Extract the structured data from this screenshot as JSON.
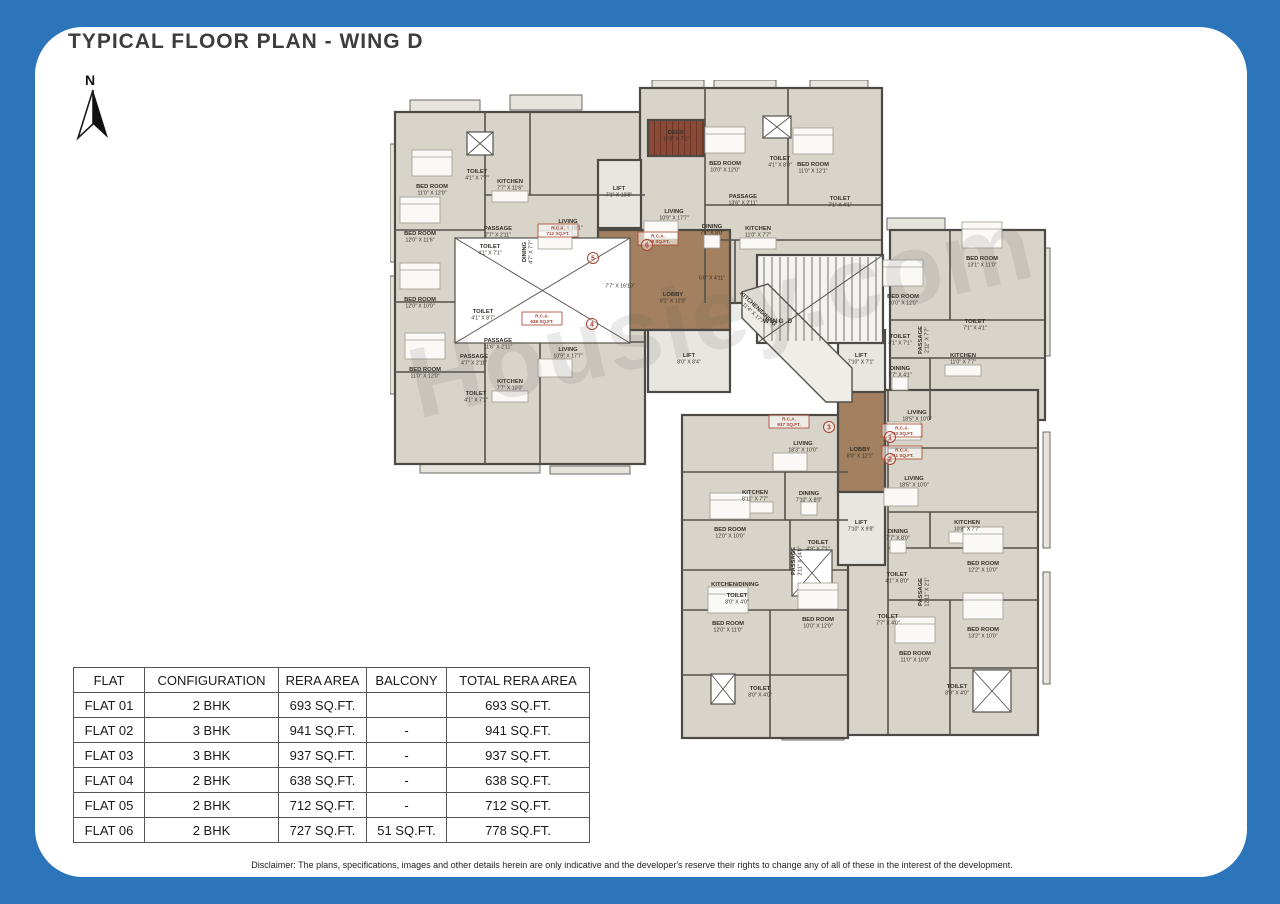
{
  "page": {
    "title": "TYPICAL FLOOR PLAN - WING D",
    "north_label": "N",
    "watermark": "Housiey.com",
    "disclaimer": "Disclaimer: The plans, specifications, images and other details herein are only indicative and the developer's reserve their rights to change any of all of these in the interest of the development.",
    "background_color": "#2c75ba"
  },
  "table": {
    "headers": [
      "FLAT",
      "CONFIGURATION",
      "RERA AREA",
      "BALCONY",
      "TOTAL RERA AREA"
    ],
    "rows": [
      [
        "FLAT 01",
        "2 BHK",
        "693 SQ.FT.",
        "",
        "693 SQ.FT."
      ],
      [
        "FLAT 02",
        "3 BHK",
        "941 SQ.FT.",
        "-",
        "941 SQ.FT."
      ],
      [
        "FLAT 03",
        "3 BHK",
        "937 SQ.FT.",
        "-",
        "937 SQ.FT."
      ],
      [
        "FLAT 04",
        "2 BHK",
        "638 SQ.FT.",
        "-",
        "638 SQ.FT."
      ],
      [
        "FLAT 05",
        "2 BHK",
        "712 SQ.FT.",
        "-",
        "712 SQ.FT."
      ],
      [
        "FLAT 06",
        "2 BHK",
        "727 SQ.FT.",
        "51 SQ.FT.",
        "778 SQ.FT."
      ]
    ]
  },
  "plan": {
    "colors": {
      "unit": "#d9d4c9",
      "lobby": "#a3805f",
      "lift": "#e8e6e0",
      "stair": "#f4f3ef",
      "corridor": "#efede7",
      "balcony": "#e7e4dd",
      "wall": "#4d4a45",
      "innerwall": "#55524c",
      "deck": "#8a4a38",
      "deckline": "#6e3527",
      "label": "#34302a",
      "red": "#a8422f",
      "furn": "#faf9f6",
      "furnline": "#a09a90"
    },
    "blocks": [
      {
        "x": 5,
        "y": 32,
        "w": 250,
        "h": 352,
        "f": "unit"
      },
      {
        "x": 250,
        "y": 8,
        "w": 242,
        "h": 215,
        "f": "unit"
      },
      {
        "x": 500,
        "y": 150,
        "w": 155,
        "h": 190,
        "f": "unit"
      },
      {
        "x": 455,
        "y": 310,
        "w": 193,
        "h": 345,
        "f": "unit"
      },
      {
        "x": 292,
        "y": 335,
        "w": 166,
        "h": 323,
        "f": "unit"
      },
      {
        "x": 208,
        "y": 150,
        "w": 132,
        "h": 100,
        "f": "lobby"
      },
      {
        "x": 448,
        "y": 300,
        "w": 47,
        "h": 112,
        "f": "lobby"
      },
      {
        "x": 208,
        "y": 80,
        "w": 43,
        "h": 68,
        "f": "lift"
      },
      {
        "x": 258,
        "y": 250,
        "w": 82,
        "h": 62,
        "f": "lift"
      },
      {
        "x": 448,
        "y": 250,
        "w": 47,
        "h": 62,
        "f": "lift"
      },
      {
        "x": 448,
        "y": 412,
        "w": 47,
        "h": 73,
        "f": "lift"
      },
      {
        "x": 367,
        "y": 175,
        "w": 126,
        "h": 88,
        "f": "stair"
      },
      {
        "x": 258,
        "y": 40,
        "w": 56,
        "h": 36,
        "f": "deck"
      }
    ],
    "corridor": {
      "points": "352,212 378,204 462,288 462,322 436,322 352,238"
    },
    "balconies": [
      [
        20,
        20,
        70,
        13
      ],
      [
        120,
        15,
        72,
        15
      ],
      [
        0,
        64,
        7,
        118
      ],
      [
        0,
        196,
        7,
        118
      ],
      [
        262,
        0,
        52,
        9
      ],
      [
        324,
        0,
        62,
        9
      ],
      [
        420,
        0,
        58,
        9
      ],
      [
        497,
        138,
        58,
        12
      ],
      [
        653,
        168,
        7,
        108
      ],
      [
        653,
        352,
        7,
        116
      ],
      [
        653,
        492,
        7,
        112
      ],
      [
        308,
        650,
        72,
        8
      ],
      [
        392,
        652,
        62,
        8
      ],
      [
        462,
        646,
        66,
        9
      ],
      [
        548,
        642,
        66,
        10
      ],
      [
        30,
        384,
        120,
        9
      ],
      [
        160,
        386,
        80,
        8
      ]
    ],
    "xboxes": [
      [
        65,
        158,
        175,
        105
      ],
      [
        77,
        52,
        26,
        23
      ],
      [
        373,
        36,
        28,
        22
      ],
      [
        402,
        470,
        40,
        46
      ],
      [
        321,
        594,
        24,
        30
      ],
      [
        583,
        590,
        38,
        42
      ]
    ],
    "walls": [
      [
        5,
        150,
        95,
        150
      ],
      [
        5,
        222,
        95,
        222
      ],
      [
        5,
        292,
        95,
        292
      ],
      [
        95,
        32,
        95,
        384
      ],
      [
        95,
        115,
        255,
        115
      ],
      [
        95,
        262,
        255,
        262
      ],
      [
        140,
        32,
        140,
        115
      ],
      [
        150,
        262,
        150,
        384
      ],
      [
        315,
        8,
        315,
        223
      ],
      [
        398,
        8,
        398,
        125
      ],
      [
        315,
        125,
        492,
        125
      ],
      [
        315,
        160,
        492,
        160
      ],
      [
        345,
        160,
        345,
        223
      ],
      [
        560,
        150,
        560,
        240
      ],
      [
        500,
        240,
        655,
        240
      ],
      [
        500,
        278,
        655,
        278
      ],
      [
        540,
        278,
        540,
        340
      ],
      [
        498,
        310,
        498,
        655
      ],
      [
        498,
        368,
        648,
        368
      ],
      [
        498,
        432,
        648,
        432
      ],
      [
        498,
        468,
        648,
        468
      ],
      [
        498,
        520,
        648,
        520
      ],
      [
        540,
        432,
        540,
        468
      ],
      [
        560,
        520,
        560,
        655
      ],
      [
        560,
        588,
        648,
        588
      ],
      [
        292,
        392,
        458,
        392
      ],
      [
        292,
        440,
        458,
        440
      ],
      [
        395,
        392,
        395,
        440
      ],
      [
        292,
        490,
        458,
        490
      ],
      [
        400,
        440,
        400,
        490
      ],
      [
        292,
        530,
        458,
        530
      ],
      [
        380,
        530,
        380,
        658
      ],
      [
        292,
        595,
        458,
        595
      ]
    ],
    "stairs": {
      "x": 367,
      "y": 175,
      "w": 126,
      "h": 88
    },
    "labels": [
      {
        "t": "BED ROOM",
        "d": "11'0\" X 12'0\"",
        "x": 42,
        "y": 108
      },
      {
        "t": "TOILET",
        "d": "4'1\" X 7'7\"",
        "x": 87,
        "y": 93
      },
      {
        "t": "KITCHEN",
        "d": "7'7\" X 11'6\"",
        "x": 120,
        "y": 103
      },
      {
        "t": "PASSAGE",
        "d": "7'7\" X 2'11\"",
        "x": 108,
        "y": 150
      },
      {
        "t": "LIVING",
        "d": "12'0\" X 18'1\"",
        "x": 178,
        "y": 143
      },
      {
        "t": "BED ROOM",
        "d": "12'0\" X 11'6\"",
        "x": 30,
        "y": 155
      },
      {
        "t": "TOILET",
        "d": "4'1\" X 7'1\"",
        "x": 100,
        "y": 168
      },
      {
        "t": "DINING",
        "d": "4'7\" X 7'7\"",
        "x": 136,
        "y": 172,
        "rot": -90
      },
      {
        "t": "TOILET",
        "d": "4'1\" X 8'7\"",
        "x": 93,
        "y": 233
      },
      {
        "t": "BED ROOM",
        "d": "12'0\" X 10'0\"",
        "x": 30,
        "y": 221
      },
      {
        "t": "PASSAGE",
        "d": "11'6\" X 2'11\"",
        "x": 108,
        "y": 262
      },
      {
        "t": "PASSAGE",
        "d": "4'7\" X 2'11\"",
        "x": 84,
        "y": 278
      },
      {
        "t": "BED ROOM",
        "d": "11'0\" X 12'0\"",
        "x": 35,
        "y": 291
      },
      {
        "t": "TOILET",
        "d": "4'1\" X 7'1\"",
        "x": 86,
        "y": 315
      },
      {
        "t": "KITCHEN",
        "d": "7'7\" X 10'0\"",
        "x": 120,
        "y": 303
      },
      {
        "t": "LIVING",
        "d": "10'9\" X 17'7\"",
        "x": 178,
        "y": 271
      },
      {
        "t": "DECK",
        "d": "10'8\" X 7'1\"",
        "x": 286,
        "y": 54
      },
      {
        "t": "LIVING",
        "d": "10'9\" X 17'7\"",
        "x": 284,
        "y": 133
      },
      {
        "t": "BED ROOM",
        "d": "10'0\" X 12'0\"",
        "x": 335,
        "y": 85
      },
      {
        "t": "TOILET",
        "d": "4'1\" X 8'0\"",
        "x": 390,
        "y": 80
      },
      {
        "t": "BED ROOM",
        "d": "11'0\" X 12'1\"",
        "x": 423,
        "y": 86
      },
      {
        "t": "PASSAGE",
        "d": "13'6\" X 2'11\"",
        "x": 353,
        "y": 118
      },
      {
        "t": "TOILET",
        "d": "7'1\" X 4'1\"",
        "x": 450,
        "y": 120
      },
      {
        "t": "DINING",
        "d": "7'1\" X 8'0\"",
        "x": 322,
        "y": 148
      },
      {
        "t": "KITCHEN",
        "d": "11'0\" X 7'7\"",
        "x": 368,
        "y": 150
      },
      {
        "t": "LIFT",
        "d": "7'1\" X 10'8\"",
        "x": 229,
        "y": 110
      },
      {
        "t": "",
        "d": "7'7\" X 16'10\"",
        "x": 230,
        "y": 201
      },
      {
        "t": "LOBBY",
        "d": "9'1\" X 12'0\"",
        "x": 283,
        "y": 216
      },
      {
        "t": "",
        "d": "5'8\" X 4'11\"",
        "x": 322,
        "y": 193
      },
      {
        "t": "LIFT",
        "d": "8'0\" X 8'4\"",
        "x": 299,
        "y": 277
      },
      {
        "t": "WING D",
        "d": "",
        "x": 388,
        "y": 243,
        "bold": 1
      },
      {
        "t": "KITCHEN/DINING",
        "d": "11'4\" X 17'7\"",
        "x": 367,
        "y": 230,
        "rot": 43
      },
      {
        "t": "LIFT",
        "d": "7'10\" X 7'1\"",
        "x": 471,
        "y": 277
      },
      {
        "t": "BED ROOM",
        "d": "10'0\" X 12'0\"",
        "x": 513,
        "y": 218
      },
      {
        "t": "BED ROOM",
        "d": "13'1\" X 11'0\"",
        "x": 592,
        "y": 180
      },
      {
        "t": "TOILET",
        "d": "7'1\" X 4'1\"",
        "x": 585,
        "y": 243
      },
      {
        "t": "TOILET",
        "d": "4'1\" X 7'1\"",
        "x": 510,
        "y": 258
      },
      {
        "t": "PASSAGE",
        "d": "2'11\" X 7'7\"",
        "x": 532,
        "y": 260,
        "rot": -90
      },
      {
        "t": "DINING",
        "d": "7'7\" X 4'1\"",
        "x": 510,
        "y": 290
      },
      {
        "t": "KITCHEN",
        "d": "11'0\" X 7'7\"",
        "x": 573,
        "y": 277
      },
      {
        "t": "LIVING",
        "d": "18'5\" X 10'0\"",
        "x": 527,
        "y": 334
      },
      {
        "t": "LIVING",
        "d": "18'5\" X 10'0\"",
        "x": 524,
        "y": 400
      },
      {
        "t": "KITCHEN",
        "d": "10'8\" X 7'7\"",
        "x": 577,
        "y": 444
      },
      {
        "t": "DINING",
        "d": "7'7\" X 8'0\"",
        "x": 508,
        "y": 453
      },
      {
        "t": "TOILET",
        "d": "4'1\" X 8'0\"",
        "x": 507,
        "y": 496
      },
      {
        "t": "PASSAGE",
        "d": "12'11\" X 2'1\"",
        "x": 532,
        "y": 512,
        "rot": -90
      },
      {
        "t": "TOILET",
        "d": "7'7\" X 4'0\"",
        "x": 498,
        "y": 538
      },
      {
        "t": "BED ROOM",
        "d": "12'2\" X 10'0\"",
        "x": 593,
        "y": 485
      },
      {
        "t": "BED ROOM",
        "d": "13'2\" X 10'0\"",
        "x": 593,
        "y": 551
      },
      {
        "t": "BED ROOM",
        "d": "11'0\" X 10'0\"",
        "x": 525,
        "y": 575
      },
      {
        "t": "TOILET",
        "d": "8'0\" X 4'0\"",
        "x": 567,
        "y": 608
      },
      {
        "t": "LOBBY",
        "d": "8'0\" X 12'1\"",
        "x": 470,
        "y": 371
      },
      {
        "t": "LIFT",
        "d": "7'10\" X 9'8\"",
        "x": 471,
        "y": 444
      },
      {
        "t": "LIVING",
        "d": "18'3\" X 10'0\"",
        "x": 413,
        "y": 365
      },
      {
        "t": "KITCHEN",
        "d": "8'11\" X 7'7\"",
        "x": 365,
        "y": 414
      },
      {
        "t": "DINING",
        "d": "7'10\" X 8'0\"",
        "x": 419,
        "y": 415
      },
      {
        "t": "TOILET",
        "d": "4'9\" X 7'1\"",
        "x": 428,
        "y": 464
      },
      {
        "t": "BED ROOM",
        "d": "12'0\" X 10'0\"",
        "x": 340,
        "y": 451
      },
      {
        "t": "PASSAGE",
        "d": "2'11\" X 14'0\"",
        "x": 405,
        "y": 481,
        "rot": -90
      },
      {
        "t": "KITCHEN/DINING",
        "d": "",
        "x": 345,
        "y": 506
      },
      {
        "t": "TOILET",
        "d": "8'0\" X 4'0\"",
        "x": 347,
        "y": 517
      },
      {
        "t": "BED ROOM",
        "d": "12'0\" X 11'0\"",
        "x": 338,
        "y": 545
      },
      {
        "t": "BED ROOM",
        "d": "10'0\" X 12'0\"",
        "x": 428,
        "y": 541
      },
      {
        "t": "TOILET",
        "d": "8'0\" X 4'0\"",
        "x": 370,
        "y": 610
      }
    ],
    "rca": [
      {
        "n": "1",
        "t": "R.C.A.",
        "v": "693 SQ.FT.",
        "bx": 512,
        "by": 350,
        "cx": 500,
        "cy": 357
      },
      {
        "n": "2",
        "t": "R.C.A.",
        "v": "941 SQ.FT.",
        "bx": 512,
        "by": 372,
        "cx": 500,
        "cy": 379
      },
      {
        "n": "3",
        "t": "R.C.A.",
        "v": "937 SQ.FT.",
        "bx": 399,
        "by": 341,
        "cx": 439,
        "cy": 347
      },
      {
        "n": "4",
        "t": "R.C.A.",
        "v": "638 SQ.FT.",
        "bx": 152,
        "by": 238,
        "cx": 202,
        "cy": 244
      },
      {
        "n": "5",
        "t": "R.C.A.",
        "v": "712 SQ.FT.",
        "bx": 168,
        "by": 150,
        "cx": 203,
        "cy": 178
      },
      {
        "n": "6",
        "t": "R.C.A.",
        "v": "778 SQ.FT.",
        "bx": 268,
        "by": 158,
        "cx": 257,
        "cy": 165
      }
    ]
  }
}
